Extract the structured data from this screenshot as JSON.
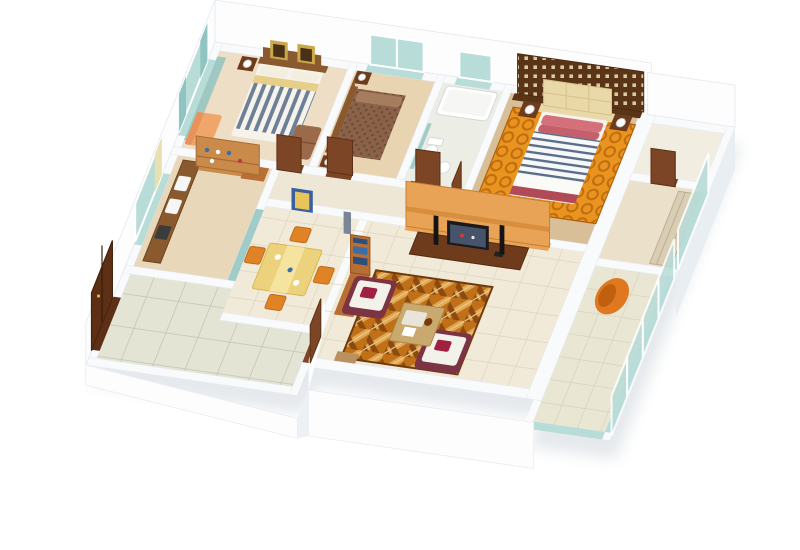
{
  "scene_title": "",
  "palette": {
    "white": "#ffffff",
    "wall": "#f8fafc",
    "wallShade": "#edf1f5",
    "wallFace": "#fdfdfe",
    "wallTint": "#e9eef3",
    "shadow": "#aab6c2",
    "floorBed1": "#eedec6",
    "floorBed2": "#e9d4b2",
    "floorBath": "#eceee6",
    "floorMaster": "#d8bf97",
    "floorCorridor": "#efe7d6",
    "floorKitchen": "#e8d7b8",
    "floorLiving": "#f1ead9",
    "floorFoyer": "#e4e4d4",
    "floorStore": "#f2ede1",
    "floorDressing": "#ebe0ca",
    "floorBalcony": "#eae6d4",
    "tileLine": "#dcd4c0",
    "tileLineFoyer": "#c6c7b6",
    "tileLineBalcony": "#d2ceb8",
    "woodDark": "#6e3b1d",
    "woodDoor": "#7b4526",
    "woodDoorDark": "#5d3015",
    "woodMid": "#8a5a2e",
    "woodShelf": "#c98a4a",
    "woodBook": "#b96f33",
    "glassTeal": "#b8dcd8",
    "glassTealDeep": "#9fccc8",
    "curtainTeal": "#8fc4c0",
    "curtainYellow": "#e8e0b0",
    "bedWhite": "#f5f3ec",
    "duvetBlue": "#6d8096",
    "duvetNavy": "#5a6e88",
    "pillowCream": "#f3eedd",
    "goldSheet": "#e6cf8a",
    "spreadBrown": "#8a624a",
    "spreadBrownDark": "#6f4a34",
    "pillowBrown": "#a57c5e",
    "headboardCream": "#ead9a8",
    "lattice": "#5a3417",
    "latticeHole": "#d9c9a0",
    "pillowPink": "#d4707a",
    "pillowRose": "#c55f6a",
    "footMaroon": "#b04a56",
    "rugOrange": "#e8941e",
    "rugRing": "#c06c10",
    "carpetBase": "#c07018",
    "carpetDark": "#8a4a10",
    "carpetLight": "#e0a850",
    "carpetCream": "#ecc690",
    "chairMaroon": "#7c3344",
    "cushionWhite": "#f2f1ea",
    "pillowCrimson": "#a11f41",
    "tableTan": "#c9a96d",
    "trayWhite": "#e8e4da",
    "diningYellow": "#ecd27c",
    "runnerYellow": "#f4e4a0",
    "chairOrange": "#e08226",
    "chairOrangeDark": "#c26a12",
    "panelOrange": "#e8a356",
    "panelOrangeDark": "#c87f2e",
    "tvBlack": "#1a1a1c",
    "tvScreen": "#47536a",
    "porcelain": "#f6f7f4",
    "loungeOrange": "#e07820",
    "loungeOrangeDark": "#c05f10",
    "bottleBlue": "#3a6ea8",
    "booksBlue": "#2c4f7c",
    "artBlue": "#3a5f9e",
    "artGold": "#e8c45a",
    "frameGold": "#caa84a",
    "lampWhite": "#fbfbf8",
    "sofaBrown": "#9a6a4a",
    "chaisePeach": "#f0a56a",
    "chaisePeachDark": "#e8915a",
    "vaseGray": "#7a8696",
    "counterWood": "#8a5a2e",
    "stoveDark": "#3c3c3c",
    "wardrobe": "#d9cdb4",
    "bowlBrown": "#7a3a10",
    "stoolTan": "#b9905f"
  }
}
